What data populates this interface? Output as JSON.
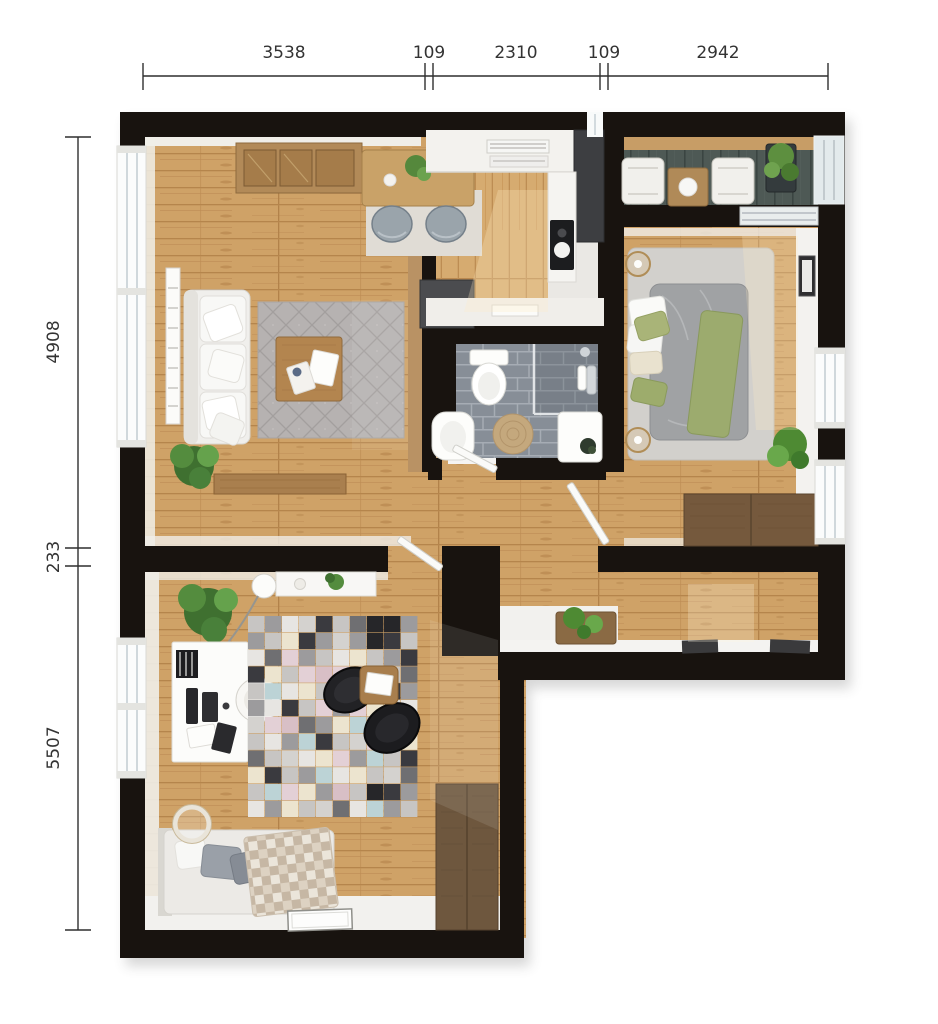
{
  "dimensions": {
    "top": [
      {
        "label": "3538"
      },
      {
        "label": "109"
      },
      {
        "label": "2310"
      },
      {
        "label": "109"
      },
      {
        "label": "2942"
      }
    ],
    "left": [
      {
        "label": "4908"
      },
      {
        "label": "233"
      },
      {
        "label": "5507"
      }
    ]
  },
  "plan": {
    "type": "apartment-floor-plan-top-view",
    "rooms": [
      "living-room",
      "kitchen",
      "bathroom",
      "bedroom",
      "balcony",
      "hallway",
      "home-office"
    ],
    "colors": {
      "wall": "#18130f",
      "wood_floor": "#cfa267",
      "kitchen_floor": "#eae8e4",
      "bathroom_tile": "#878e97",
      "balcony_deck": "#4e5955",
      "living_rug": "#b6b2b1",
      "bedroom_rug": "#d2d0cc",
      "sofa": "#f2f1ee",
      "bed_duvet": "#a0a2a4",
      "bed_throw": "#9cab6e",
      "wardrobe": "#75593d",
      "desk": "#fbfbf9",
      "office_chairs": "#202023",
      "dimension_text": "#333333"
    }
  },
  "office_rug": {
    "x": 248,
    "y": 616,
    "cols": 10,
    "cell_w": 17,
    "cell_h": 16.8,
    "palette": [
      "#e7e5e2",
      "#c7c5c3",
      "#9c9b9d",
      "#6f6f72",
      "#3a3a3f",
      "#e3d0d6",
      "#d8bfc6",
      "#bcd3d6",
      "#ece4cf",
      "#d4d2cf",
      "#88878a",
      "#262629"
    ],
    "rows": [
      "1209413bb2",
      "2184292b41",
      "0352108124",
      "4815652713",
      "1708193242",
      "2041525890",
      "9563287131",
      "1027419528",
      "3190852714",
      "8412708193",
      "1758261b42",
      "0281930721"
    ]
  }
}
